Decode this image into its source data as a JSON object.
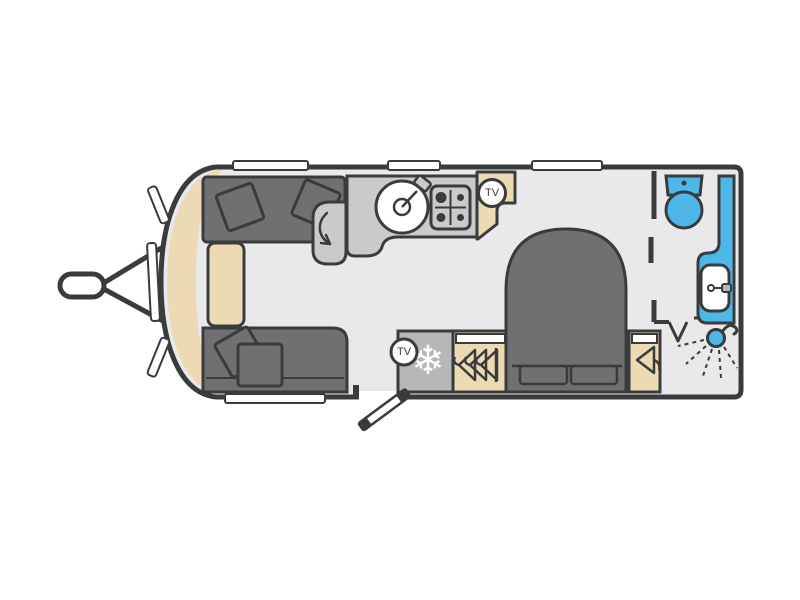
{
  "diagram": {
    "type": "caravan-floorplan",
    "labels": {
      "tv_front": "TV",
      "tv_rear": "TV"
    },
    "icons": {
      "freezer": "❄"
    }
  },
  "colors": {
    "background": "#ffffff",
    "wall": "#3a3b3d",
    "floor": "#e9e9eb",
    "upholstery": "#6f7072",
    "counter": "#c9cacc",
    "appliance": "#b6b7b9",
    "beige": "#ecdab5",
    "blue": "#4db7e9",
    "white": "#ffffff"
  }
}
